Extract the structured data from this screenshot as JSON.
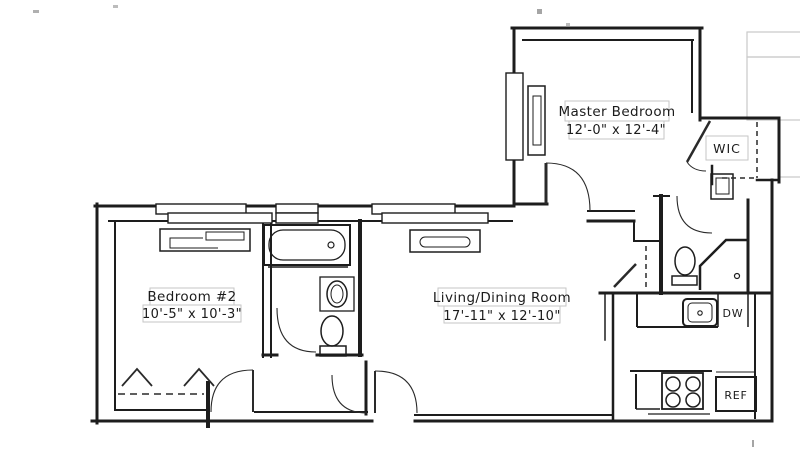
{
  "plan": {
    "type": "apartment-floor-plan",
    "rooms": {
      "master_bedroom": {
        "name": "Master Bedroom",
        "dims": "12'-0\" x 12'-4\""
      },
      "wic": {
        "name": "WIC"
      },
      "bedroom_2": {
        "name": "Bedroom #2",
        "dims": "10'-5\" x 10'-3\""
      },
      "living_dining": {
        "name": "Living/Dining Room",
        "dims": "17'-11\" x 12'-10\""
      }
    },
    "appliances": {
      "dishwasher": "DW",
      "refrigerator": "REF"
    },
    "colors": {
      "wall": "#1d1d1d",
      "faint_line": "#c9c9c9",
      "background": "#ffffff"
    }
  }
}
